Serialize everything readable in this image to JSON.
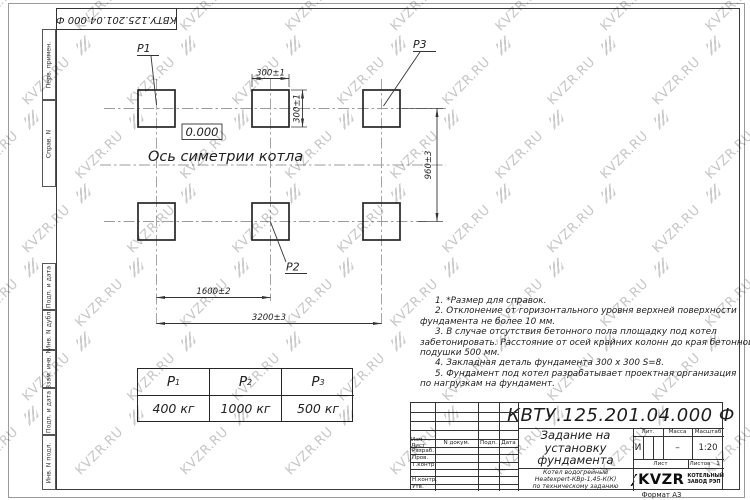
{
  "watermark": {
    "text": "KVZR.RU"
  },
  "stamp_rotated": "КВТУ.125.201.04.000 Ф",
  "margin_columns": [
    "Перв. примен.",
    "Справ. N",
    "Подп. и дата",
    "Инв. N дубл.",
    "Взам. инв. N",
    "Подп. и дата",
    "Инв. N подл."
  ],
  "drawing": {
    "elevation_mark": "0.000",
    "axis_label": "Ось симетрии котла",
    "labels": {
      "p1": "P1",
      "p2": "P2",
      "p3": "P3"
    },
    "dims": {
      "pad_width": "300±1",
      "pad_height": "300±1",
      "row_spacing": "960±3",
      "col_spacing": "1600±2",
      "total_span": "3200±3"
    }
  },
  "loads_table": {
    "headers": [
      {
        "base": "P",
        "sub": "1"
      },
      {
        "base": "P",
        "sub": "2"
      },
      {
        "base": "P",
        "sub": "3"
      }
    ],
    "values": [
      "400 кг",
      "1000 кг",
      "500 кг"
    ]
  },
  "notes": [
    {
      "text": "1.  *Размер для справок.",
      "indent": true
    },
    {
      "text": "2.  Отклонение от горизонтального уровня верхней поверхности",
      "indent": true
    },
    {
      "text": "фундамента не более 10 мм.",
      "indent": false
    },
    {
      "text": "3.  В случае отсутствия бетонного пола площадку под котел",
      "indent": true
    },
    {
      "text": "забетонировать. Расстояние от осей крайних колонн до края бетонной",
      "indent": false
    },
    {
      "text": "подушки 500 мм.",
      "indent": false
    },
    {
      "text": "4.  Закладная деталь фундамента  300 x 300 S=8.",
      "indent": true
    },
    {
      "text": "5.  Фундамент под котел разрабатывает проектная организация",
      "indent": true
    },
    {
      "text": "по нагрузкам на фундамент.",
      "indent": false
    }
  ],
  "title_block": {
    "doc_number": "КВТУ.125.201.04.000  Ф",
    "title_lines": [
      "Задание на",
      "установку",
      "фундамента"
    ],
    "subtitle_lines": [
      "Котел водогрейный",
      "Heatexpert-КВр-1,45-К(К)",
      "по техническому заданию"
    ],
    "columns_header": [
      "Изм Лист",
      "N докум.",
      "Подп.",
      "Дата"
    ],
    "signature_rows": [
      "Разраб.",
      "Пров.",
      "Т.контр.",
      "",
      "Н.контр.",
      "Утв."
    ],
    "lit": {
      "label": "Лит.",
      "value": "И"
    },
    "mass": {
      "label": "Масса",
      "value": "–"
    },
    "scale": {
      "label": "Масштаб",
      "value": "1:20"
    },
    "sheet": {
      "label": "Лист",
      "value": ""
    },
    "sheets": {
      "label": "Листов",
      "value": "1"
    },
    "company": {
      "name": "KVZR",
      "tagline": [
        "КОТЕЛЬНЫЙ",
        "ЗАВОД РЭП"
      ]
    },
    "format_label": "Формат А3"
  }
}
